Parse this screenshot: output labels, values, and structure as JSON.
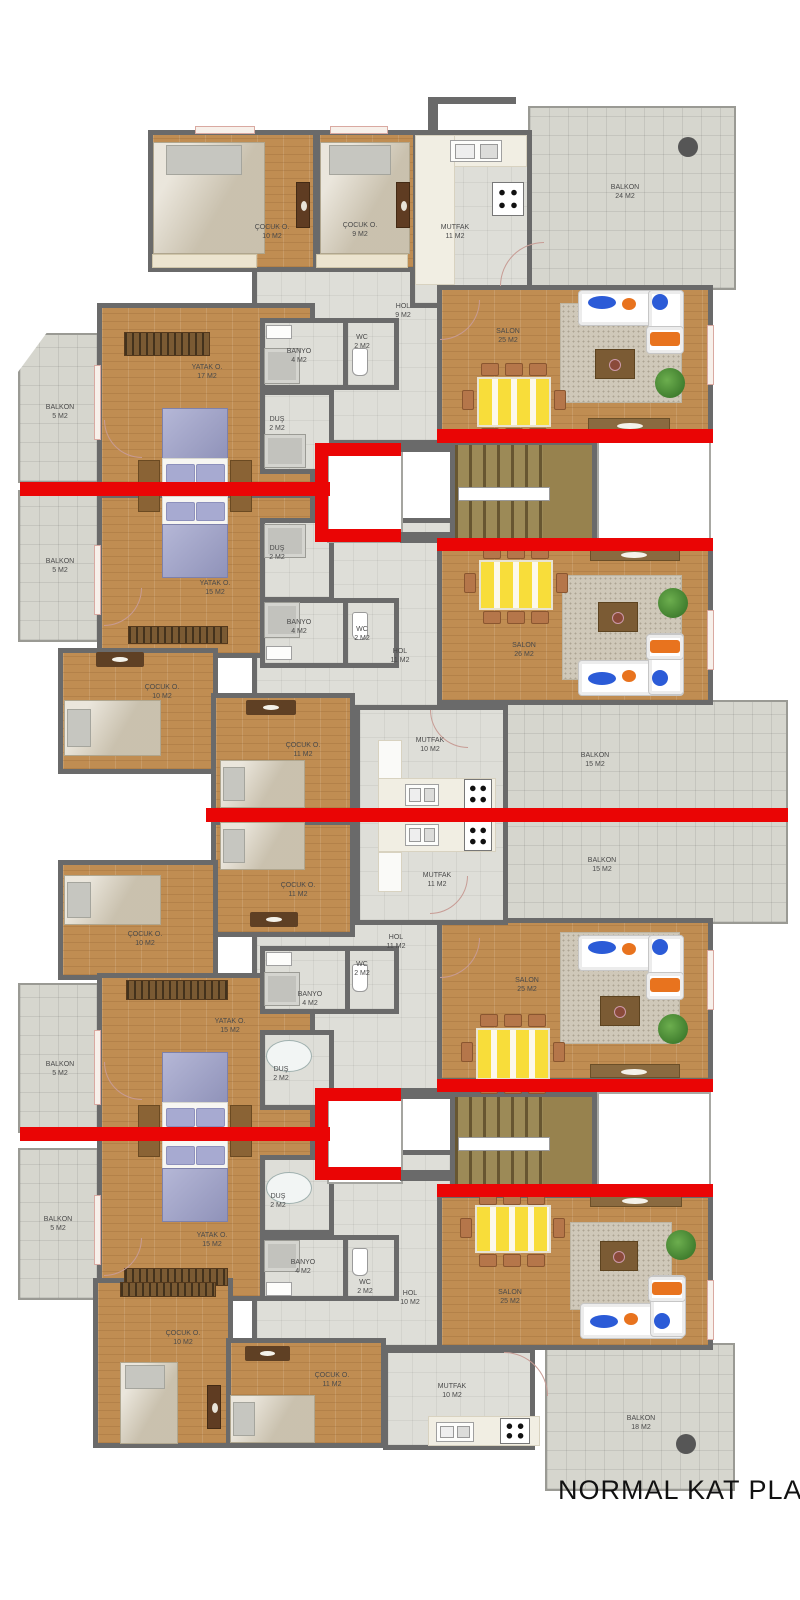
{
  "title": "NORMAL KAT PLANI",
  "colors": {
    "wall": "#6a6a6a",
    "red": "#ea0505",
    "wood": "#c08d52",
    "tile": "#deded8",
    "balcony": "#d6d6ce"
  },
  "rooms": [
    {
      "name": "ÇOCUK O.",
      "area": "10 M2"
    },
    {
      "name": "ÇOCUK O.",
      "area": "9 M2"
    },
    {
      "name": "MUTFAK",
      "area": "11 M2"
    },
    {
      "name": "BALKON",
      "area": "24 M2"
    },
    {
      "name": "HOL",
      "area": "9 M2"
    },
    {
      "name": "SALON",
      "area": "25 M2"
    },
    {
      "name": "BANYO",
      "area": "4 M2"
    },
    {
      "name": "WC",
      "area": "2 M2"
    },
    {
      "name": "YATAK O.",
      "area": "17 M2"
    },
    {
      "name": "BALKON",
      "area": "5 M2"
    },
    {
      "name": "DUŞ",
      "area": "2 M2"
    },
    {
      "name": "DUŞ",
      "area": "2 M2"
    },
    {
      "name": "YATAK O.",
      "area": "15 M2"
    },
    {
      "name": "BALKON",
      "area": "5 M2"
    },
    {
      "name": "BANYO",
      "area": "4 M2"
    },
    {
      "name": "WC",
      "area": "2 M2"
    },
    {
      "name": "HOL",
      "area": "11 M2"
    },
    {
      "name": "SALON",
      "area": "26 M2"
    },
    {
      "name": "ÇOCUK O.",
      "area": "10 M2"
    },
    {
      "name": "ÇOCUK O.",
      "area": "11 M2"
    },
    {
      "name": "MUTFAK",
      "area": "10 M2"
    },
    {
      "name": "BALKON",
      "area": "15 M2"
    },
    {
      "name": "MUTFAK",
      "area": "11 M2"
    },
    {
      "name": "BALKON",
      "area": "15 M2"
    },
    {
      "name": "ÇOCUK O.",
      "area": "11 M2"
    },
    {
      "name": "ÇOCUK O.",
      "area": "10 M2"
    },
    {
      "name": "HOL",
      "area": "11 M2"
    },
    {
      "name": "WC",
      "area": "2 M2"
    },
    {
      "name": "BANYO",
      "area": "4 M2"
    },
    {
      "name": "YATAK O.",
      "area": "15 M2"
    },
    {
      "name": "BALKON",
      "area": "5 M2"
    },
    {
      "name": "DUŞ",
      "area": "2 M2"
    },
    {
      "name": "SALON",
      "area": "25 M2"
    },
    {
      "name": "DUŞ",
      "area": "2 M2"
    },
    {
      "name": "YATAK O.",
      "area": "15 M2"
    },
    {
      "name": "BALKON",
      "area": "5 M2"
    },
    {
      "name": "BANYO",
      "area": "4 M2"
    },
    {
      "name": "WC",
      "area": "2 M2"
    },
    {
      "name": "HOL",
      "area": "10 M2"
    },
    {
      "name": "SALON",
      "area": "25 M2"
    },
    {
      "name": "ÇOCUK O.",
      "area": "10 M2"
    },
    {
      "name": "ÇOCUK O.",
      "area": "11 M2"
    },
    {
      "name": "MUTFAK",
      "area": "10 M2"
    },
    {
      "name": "BALKON",
      "area": "18 M2"
    }
  ]
}
